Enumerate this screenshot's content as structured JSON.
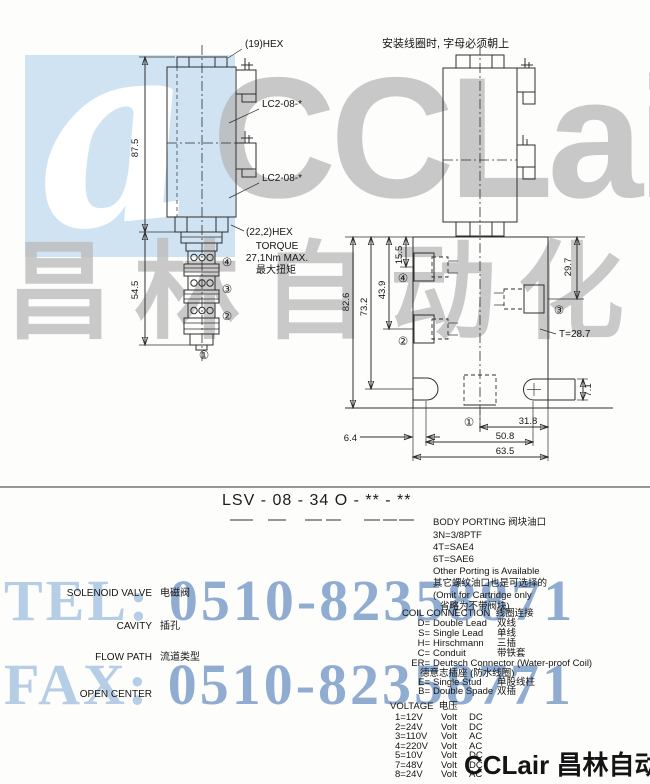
{
  "watermark": {
    "logo_glyph": "a",
    "brand": "CCLair",
    "brand_cn": "昌林自动化",
    "tel_label": "TEL:",
    "tel_number": "0510-82358871",
    "fax_label": "FAX:",
    "fax_number": "0510-82358771",
    "footer": "CCLair 昌林自动化",
    "colors": {
      "panel_blue": "#cfe3f3",
      "grey": "#b5b5b5",
      "blue_light": "#b6cde6",
      "blue_dark": "#7e9fc9"
    }
  },
  "port_markers": {
    "p1": "①",
    "p2": "②",
    "p3": "③",
    "p4": "④"
  },
  "front_view": {
    "hex_top_label": "(19)HEX",
    "cavity_label_1": "LC2-08-*",
    "cavity_label_2": "LC2-08-*",
    "dim_coil_height": "87.5",
    "dim_cartridge_height": "54.5",
    "hex_bottom_label": "(22,2)HEX",
    "torque_title": "TORQUE",
    "torque_value": "27,1Nm MAX.",
    "torque_cn": "最大扭矩"
  },
  "side_view": {
    "note_cn": "安装线圈时, 字母必须朝上",
    "dim_82_6": "82.6",
    "dim_73_2": "73.2",
    "dim_43_9": "43.9",
    "dim_15_5": "15.5",
    "dim_29_7": "29.7",
    "thread_label": "T=28.7",
    "dim_31_8": "31.8",
    "dim_50_8": "50.8",
    "dim_63_5": "63.5",
    "dim_6_4": "6.4",
    "dim_7_1": "7.1"
  },
  "model_code": {
    "code": "LSV - 08 - 34 O - ** - **"
  },
  "legend": {
    "left": [
      {
        "en": "SOLENOID VALVE",
        "cn": "电磁阀"
      },
      {
        "en": "CAVITY",
        "cn": "插孔"
      },
      {
        "en": "FLOW PATH",
        "cn": "流道类型"
      },
      {
        "en": "OPEN CENTER",
        "cn": ""
      }
    ],
    "body_porting": {
      "title_en": "BODY PORTING",
      "title_cn": "阀块油口",
      "lines": [
        "3N=3/8PTF",
        "4T=SAE4",
        "6T=SAE6",
        "Other Porting is Available",
        "其它螺纹油口也是可选择的",
        "(Omit for Cartridge only",
        "省略为不带阀块)"
      ]
    },
    "coil_connection": {
      "title_en": "COIL CONNECTION",
      "title_cn": "线圈连接",
      "options": [
        {
          "code": "D=",
          "en": "Double Lead",
          "cn": "双线"
        },
        {
          "code": "S=",
          "en": "Single Lead",
          "cn": "单线"
        },
        {
          "code": "H=",
          "en": "Hirschmann",
          "cn": "三插"
        },
        {
          "code": "C=",
          "en": "Conduit",
          "cn": "带铁套"
        },
        {
          "code": "ER=",
          "en": "Deutsch Connector (Water-proof Coil)",
          "cn": ""
        },
        {
          "code": "",
          "en": "",
          "cn": "德意志插座 (防水线圈)"
        },
        {
          "code": "E=",
          "en": "Single Stud",
          "cn": "单股线柱"
        },
        {
          "code": "B=",
          "en": "Double Spade",
          "cn": "双插"
        }
      ]
    },
    "voltage": {
      "title_en": "VOLTAGE",
      "title_cn": "电压",
      "rows": [
        {
          "code": "1=12V",
          "unit": "Volt",
          "type": "DC"
        },
        {
          "code": "2=24V",
          "unit": "Volt",
          "type": "DC"
        },
        {
          "code": "3=110V",
          "unit": "Volt",
          "type": "AC"
        },
        {
          "code": "4=220V",
          "unit": "Volt",
          "type": "AC"
        },
        {
          "code": "5=10V",
          "unit": "Volt",
          "type": "DC"
        },
        {
          "code": "7=48V",
          "unit": "Volt",
          "type": "DC"
        },
        {
          "code": "8=24V",
          "unit": "Volt",
          "type": "AC"
        }
      ]
    }
  }
}
